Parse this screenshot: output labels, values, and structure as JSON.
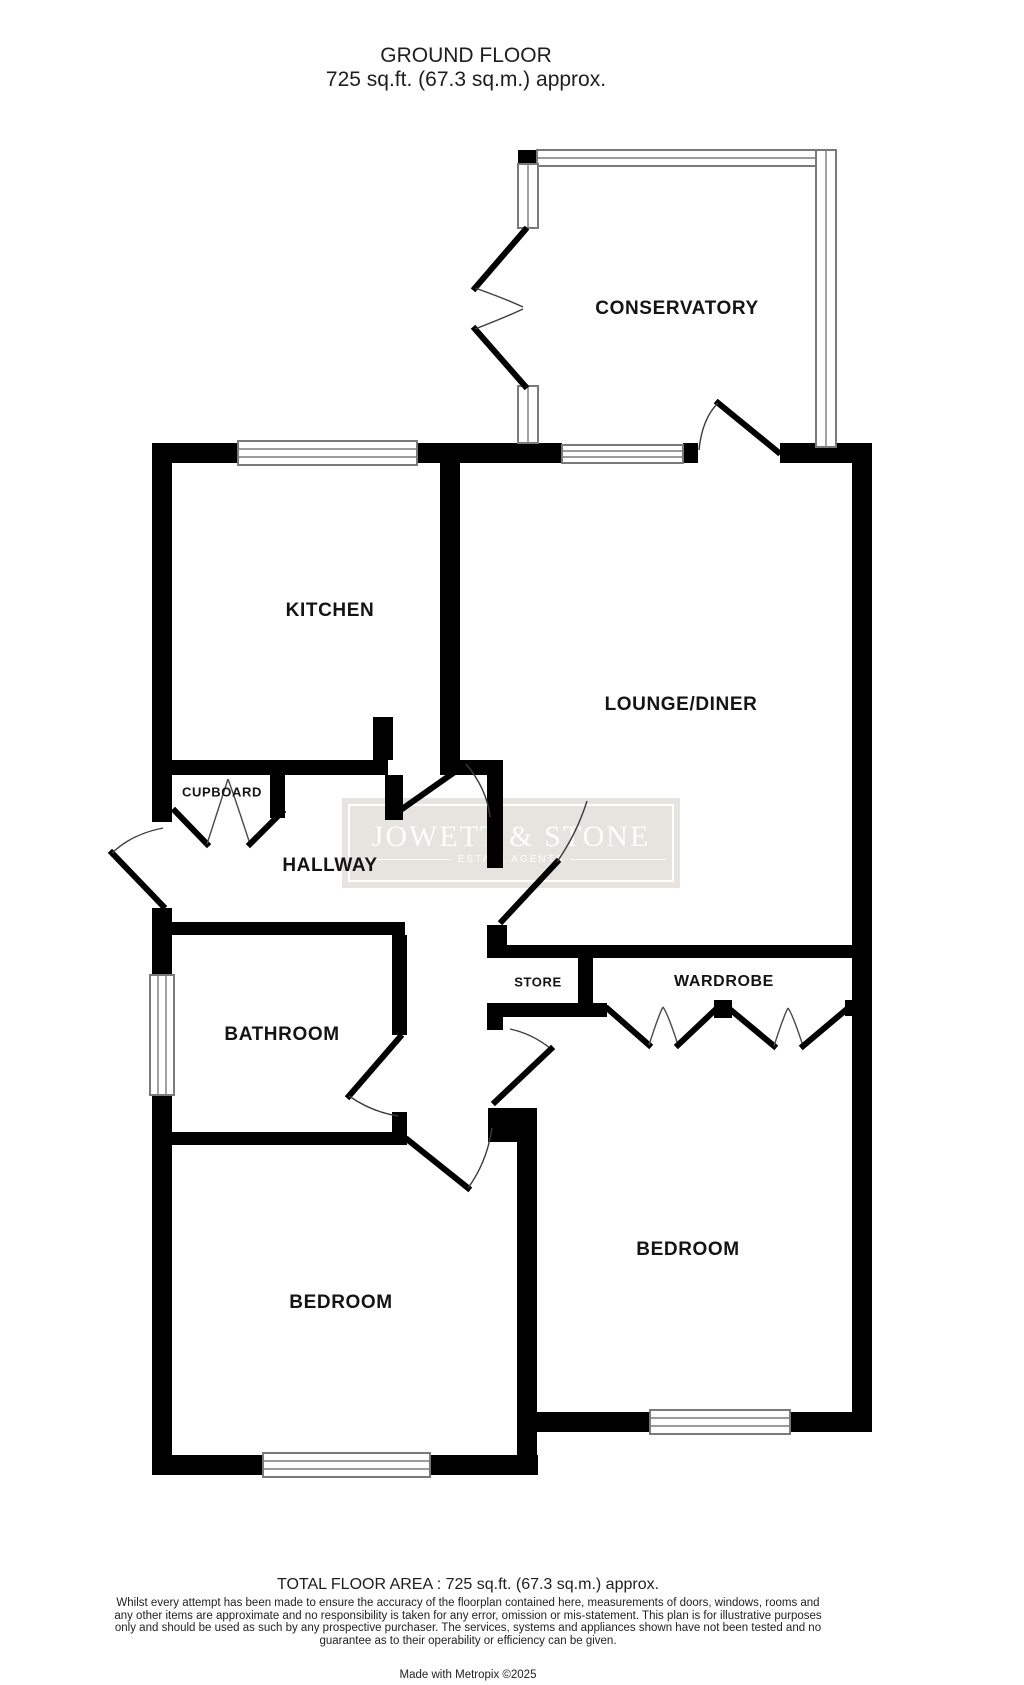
{
  "header": {
    "title": "GROUND FLOOR",
    "subtitle": "725 sq.ft. (67.3 sq.m.) approx."
  },
  "rooms": {
    "conservatory": "CONSERVATORY",
    "kitchen": "KITCHEN",
    "lounge": "LOUNGE/DINER",
    "cupboard": "CUPBOARD",
    "hallway": "HALLWAY",
    "store": "STORE",
    "wardrobe": "WARDROBE",
    "bathroom": "BATHROOM",
    "bedroom_right": "BEDROOM",
    "bedroom_left": "BEDROOM"
  },
  "watermark": {
    "name": "JOWETT & STONE",
    "tagline": "ESTATE AGENTS"
  },
  "footer": {
    "total": "TOTAL FLOOR AREA : 725 sq.ft. (67.3 sq.m.) approx.",
    "disclaimer": "Whilst every attempt has been made to ensure the accuracy of the floorplan contained here, measurements of doors, windows, rooms and any other items are approximate and no responsibility is taken for any error, omission or mis-statement. This plan is for illustrative purposes only and should be used as such by any prospective purchaser. The services, systems and appliances shown have not been tested and no guarantee as to their operability or efficiency can be given.",
    "credit": "Made with Metropix ©2025"
  },
  "colors": {
    "wall": "#000000",
    "window_line": "#7a7a7a",
    "watermark_bg": "#e7e4df",
    "watermark_text": "#fdfdfb",
    "label": "#141414"
  }
}
